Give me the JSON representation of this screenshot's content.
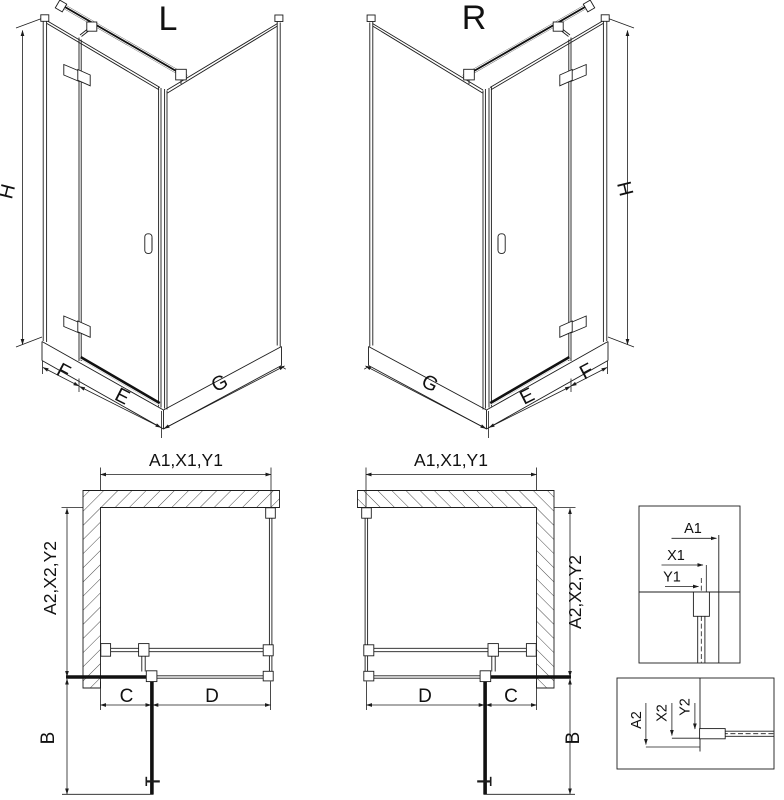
{
  "page": {
    "background": "#ffffff",
    "line_color": "#1c1c1c"
  },
  "iso_views": [
    {
      "variant_label": "L",
      "height_dim": "H",
      "side_width_dim": "F",
      "front_width_dim": "E",
      "return_width_dim": "G"
    },
    {
      "variant_label": "R",
      "height_dim": "H",
      "side_width_dim": "F",
      "front_width_dim": "E",
      "return_width_dim": "G"
    }
  ],
  "plan_views": [
    {
      "opening_dim": "A1,X1,Y1",
      "depth_dim": "A2,X2,Y2",
      "door_clearance_dim": "B",
      "fixed_segment_dim": "C",
      "door_segment_dim": "D"
    },
    {
      "opening_dim": "A1,X1,Y1",
      "depth_dim": "A2,X2,Y2",
      "door_clearance_dim": "B",
      "fixed_segment_dim": "C",
      "door_segment_dim": "D"
    }
  ],
  "detail_views": [
    {
      "dims": [
        "A1",
        "X1",
        "Y1"
      ]
    },
    {
      "dims": [
        "A2",
        "X2",
        "Y2"
      ]
    }
  ]
}
